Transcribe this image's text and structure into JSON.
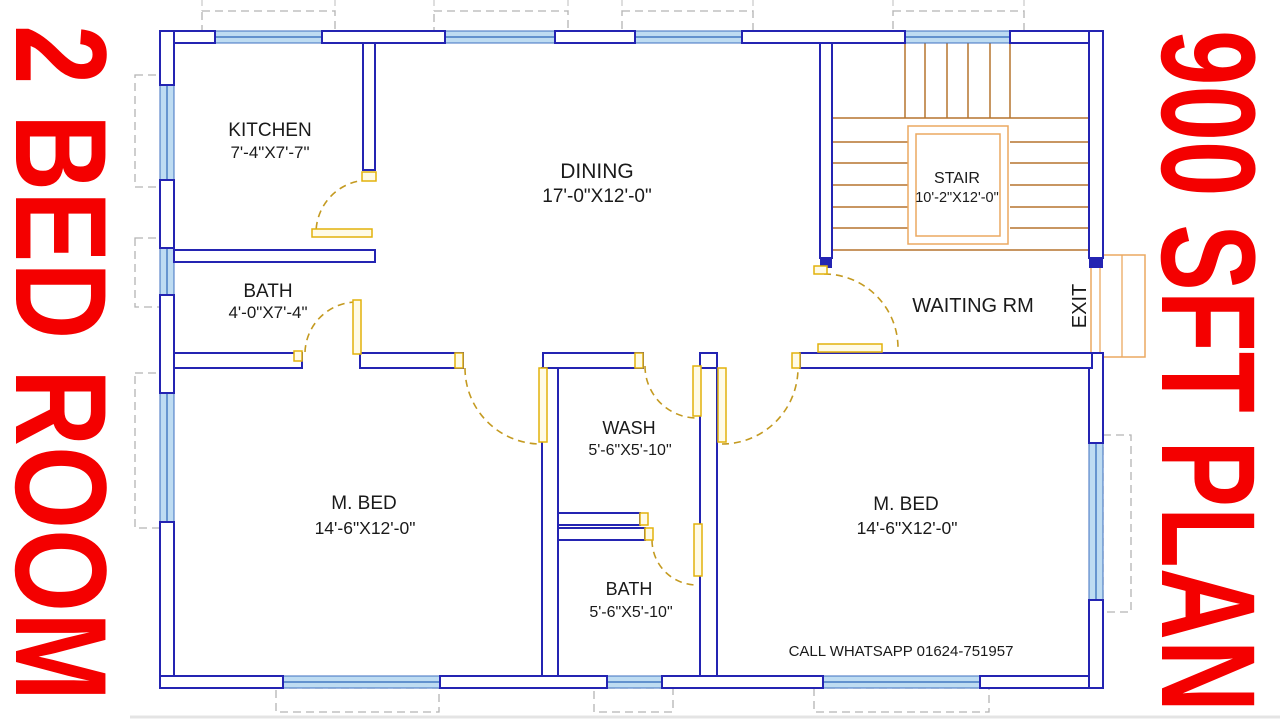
{
  "banner_left": {
    "text": "2 BED ROOM",
    "color": "#F40000"
  },
  "banner_right": {
    "text": "900 SFT PLAN",
    "color": "#F40000"
  },
  "rooms": {
    "kitchen": {
      "label": "KITCHEN",
      "dim": "7'-4\"X7'-7\""
    },
    "dining": {
      "label": "DINING",
      "dim": "17'-0\"X12'-0\""
    },
    "stair": {
      "label": "STAIR",
      "dim": "10'-2\"X12'-0\""
    },
    "bath_upper": {
      "label": "BATH",
      "dim": "4'-0\"X7'-4\""
    },
    "waiting": {
      "label": "WAITING RM"
    },
    "exit": {
      "label": "EXIT"
    },
    "mbed_left": {
      "label": "M. BED",
      "dim": "14'-6\"X12'-0\""
    },
    "wash": {
      "label": "WASH",
      "dim": "5'-6\"X5'-10\""
    },
    "bath_lower": {
      "label": "BATH",
      "dim": "5'-6\"X5'-10\""
    },
    "mbed_right": {
      "label": "M. BED",
      "dim": "14'-6\"X12'-0\""
    }
  },
  "contact": "CALL WHATSAPP 01624-751957",
  "colors": {
    "wall": "#2424B2",
    "window_fill": "#BEDCF2",
    "window_line": "#2C66B8",
    "stair_tread": "#B5742E",
    "stair_landing": "#EBA960",
    "door_leaf": "#E2B20C",
    "door_arc": "#C49A20",
    "projection_dash": "#B4B4B4",
    "banner_red": "#F40000",
    "text": "#1A1A1A",
    "background": "#FFFFFF"
  }
}
